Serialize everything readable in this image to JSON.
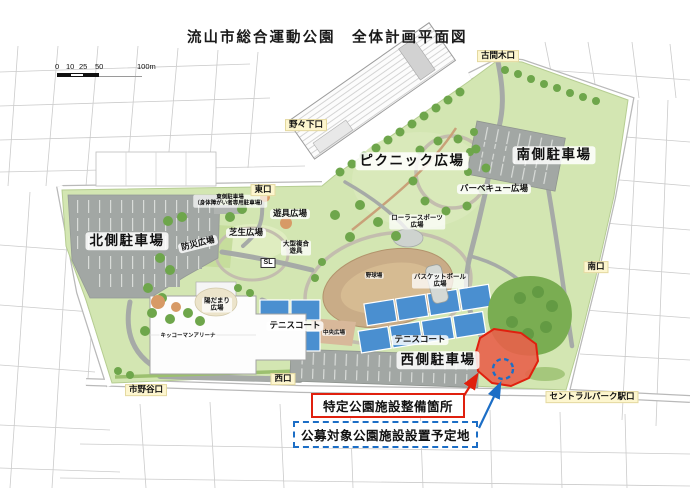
{
  "title": "流山市総合運動公園　全体計画平面図",
  "scale_bar": {
    "ticks": [
      "0",
      "10",
      "25",
      "50",
      "100m"
    ]
  },
  "legend": {
    "specific_label": "特定公園施設整備箇所",
    "proposed_label": "公募対象公園施設設置予定地"
  },
  "colors": {
    "park-green": "#d3e6b2",
    "tree-green": "#6ea64b",
    "road-gray": "#a6aaa7",
    "parking-gray": "#a2a7a4",
    "field-brown": "#c9ac87",
    "court-blue": "#4a8fd0",
    "highlight-red": "#e8604a",
    "highlight-red-border": "#e0200e",
    "proposed-blue": "#1c6ec6",
    "entrance-bg": "#fdf6cf"
  },
  "map": {
    "labels": [
      {
        "id": "north-parking",
        "text": "北側駐車場",
        "x": 127,
        "y": 241,
        "style": "large"
      },
      {
        "id": "picnic-plaza",
        "text": "ピクニック広場",
        "x": 412,
        "y": 161,
        "style": "large"
      },
      {
        "id": "south-parking",
        "text": "南側駐車場",
        "x": 554,
        "y": 155,
        "style": "large"
      },
      {
        "id": "west-parking",
        "text": "西側駐車場",
        "x": 438,
        "y": 360,
        "style": "large"
      },
      {
        "id": "bbq-plaza",
        "text": "バーベキュー広場",
        "x": 494,
        "y": 189,
        "style": "med"
      },
      {
        "id": "roller-sports-plaza",
        "text": "ローラースポーツ\n広場",
        "x": 417,
        "y": 222,
        "style": "tiny"
      },
      {
        "id": "east-parking",
        "text": "東側駐車場\n（身体障がい者専用駐車場）",
        "x": 230,
        "y": 201,
        "style": "micro"
      },
      {
        "id": "east-gate",
        "text": "東口",
        "x": 263,
        "y": 190,
        "style": "entrance"
      },
      {
        "id": "playground-plaza",
        "text": "遊具広場",
        "x": 290,
        "y": 214,
        "style": "med"
      },
      {
        "id": "lawn-plaza",
        "text": "芝生広場",
        "x": 246,
        "y": 233,
        "style": "med"
      },
      {
        "id": "disaster-plaza",
        "text": "防災広場",
        "x": 198,
        "y": 244,
        "style": "med",
        "rotate": -14
      },
      {
        "id": "large-playset",
        "text": "大型複合\n遊具",
        "x": 296,
        "y": 248,
        "style": "tiny"
      },
      {
        "id": "sl-display",
        "text": "SL",
        "x": 268,
        "y": 263,
        "style": "slbox"
      },
      {
        "id": "baseball-field",
        "text": "野球場",
        "x": 374,
        "y": 276,
        "style": "micro"
      },
      {
        "id": "basketball-plaza",
        "text": "バスケットボール\n広場",
        "x": 440,
        "y": 281,
        "style": "tiny"
      },
      {
        "id": "hidamari-plaza",
        "text": "陽だまり\n広場",
        "x": 217,
        "y": 305,
        "style": "tiny"
      },
      {
        "id": "kikkoman-arena",
        "text": "キッコーマンアリーナ",
        "x": 188,
        "y": 336,
        "style": "micro"
      },
      {
        "id": "tennis-court-left",
        "text": "テニスコート",
        "x": 295,
        "y": 326,
        "style": "med"
      },
      {
        "id": "central-plaza",
        "text": "中央広場",
        "x": 334,
        "y": 333,
        "style": "micro"
      },
      {
        "id": "tennis-court-right",
        "text": "テニスコート",
        "x": 420,
        "y": 340,
        "style": "med"
      },
      {
        "id": "komagi-gate",
        "text": "古間木口",
        "x": 498,
        "y": 56,
        "style": "entrance"
      },
      {
        "id": "nonoshita-gate",
        "text": "野々下口",
        "x": 306,
        "y": 125,
        "style": "entrance"
      },
      {
        "id": "south-gate",
        "text": "南口",
        "x": 596,
        "y": 267,
        "style": "entrance"
      },
      {
        "id": "west-gate",
        "text": "西口",
        "x": 283,
        "y": 379,
        "style": "entrance"
      },
      {
        "id": "ichinoya-gate",
        "text": "市野谷口",
        "x": 146,
        "y": 390,
        "style": "entrance"
      },
      {
        "id": "central-park-station-gate",
        "text": "セントラルパーク駅口",
        "x": 592,
        "y": 397,
        "style": "entrance"
      }
    ]
  }
}
